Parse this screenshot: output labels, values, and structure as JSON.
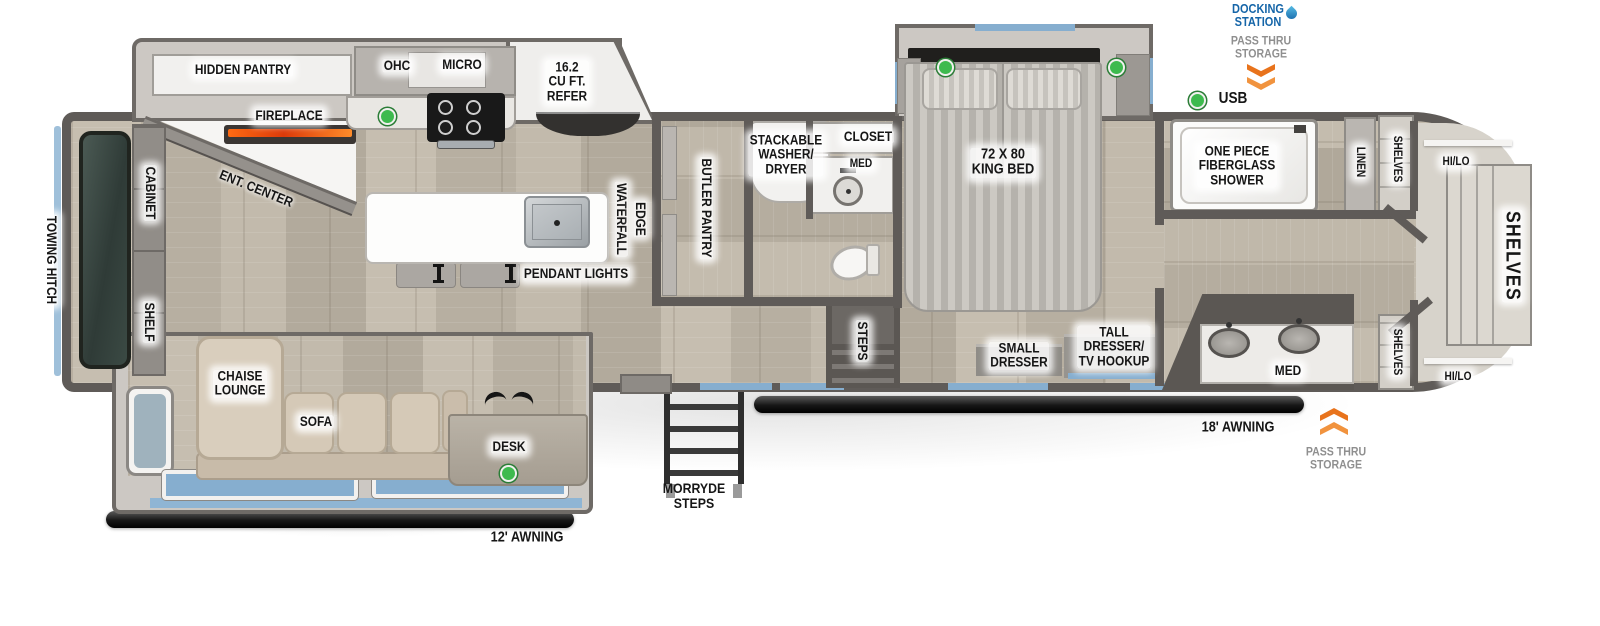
{
  "plan": {
    "exterior": {
      "towing_hitch": "TOWING HITCH",
      "awning_front": "12' AWNING",
      "awning_rear": "18' AWNING",
      "entry_steps": "MORRYDE\nSTEPS",
      "docking_station": "DOCKING\nSTATION",
      "pass_thru_front": "PASS THRU\nSTORAGE",
      "pass_thru_rear": "PASS THRU\nSTORAGE",
      "usb": "USB"
    },
    "living": {
      "hidden_pantry": "HIDDEN PANTRY",
      "fireplace": "FIREPLACE",
      "ent_center": "ENT. CENTER",
      "cabinet": "CABINET",
      "shelf": "SHELF",
      "chaise_lounge": "CHAISE\nLOUNGE",
      "sofa": "SOFA",
      "desk": "DESK"
    },
    "kitchen": {
      "ohc": "OHC",
      "micro": "MICRO",
      "refer": "16.2\nCU FT.\nREFER",
      "waterfall": "WATERFALL",
      "edge": "EDGE",
      "pendant_lights": "PENDANT LIGHTS",
      "butler_pantry": "BUTLER PANTRY"
    },
    "mid_bath": {
      "stackable_washer_dryer": "STACKABLE\nWASHER/\nDRYER",
      "closet": "CLOSET",
      "med": "MED",
      "steps": "STEPS"
    },
    "bedroom": {
      "king_bed": "72 X 80\nKING BED",
      "small_dresser": "SMALL\nDRESSER",
      "tall_dresser": "TALL\nDRESSER/\nTV HOOKUP"
    },
    "rear_bath": {
      "shower": "ONE PIECE\nFIBERGLASS\nSHOWER",
      "linen": "LINEN",
      "shelves": "SHELVES",
      "med": "MED"
    },
    "wardrobe": {
      "hilo_top": "HI/LO",
      "shelves_main": "SHELVES",
      "shelves_bottom": "SHELVES",
      "hilo_bottom": "HI/LO"
    },
    "colors": {
      "wall": "#5f5b58",
      "accent_blue": "#86aecf",
      "brand_blue": "#1565a8",
      "arrow_orange": "#e8731c",
      "usb_green": "#3dba4e",
      "gray_text": "#8f8f8f"
    }
  }
}
